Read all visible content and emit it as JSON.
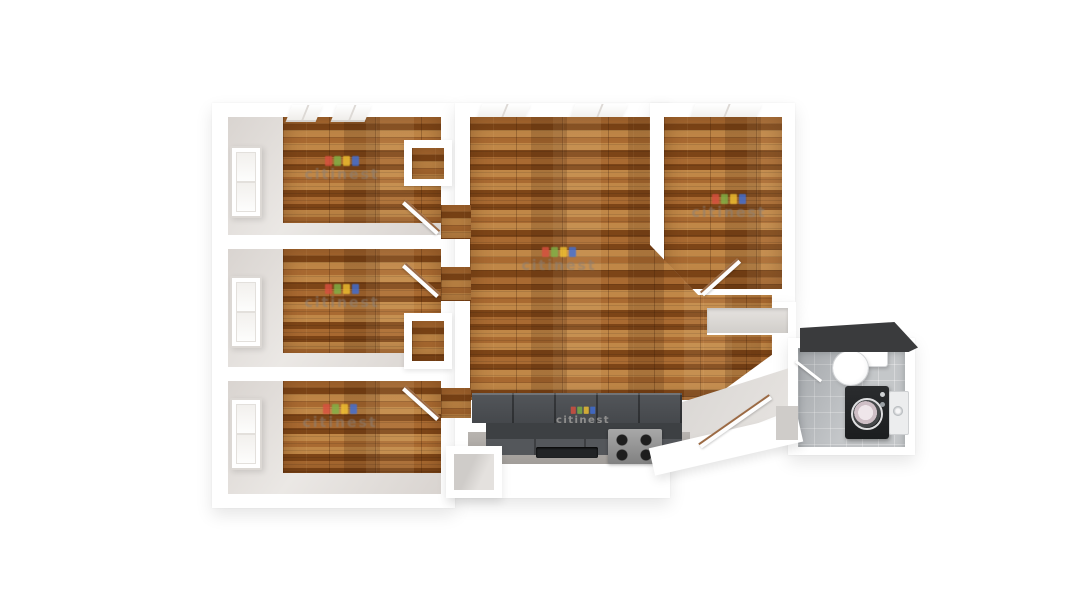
{
  "watermark": {
    "text": "citinest",
    "logo_colors": [
      "#d94f3f",
      "#7fb347",
      "#f2c230",
      "#3f6fd9"
    ]
  },
  "colors": {
    "wall_white": "#ffffff",
    "wall_face": "#d9d4d0",
    "wall_face_light": "#ebe8e5",
    "wood_light": "#c08747",
    "wood_mid": "#a96a31",
    "wood_dark": "#7d4517",
    "cabinet_upper": "#53565a",
    "cabinet_backsplash": "#3d4043",
    "cabinet_base": "#54575b",
    "counter_light": "#b8b4b0",
    "sink_dark": "#222426",
    "stove_steel": "#a8a8a8",
    "tile_base": "#bcbfc2",
    "appliance_black": "#1b1d1f",
    "roof_dark": "#3a3b3d",
    "entry_floor": "#d6d3d0",
    "watermark_text": "#8a8078"
  },
  "rooms": [
    {
      "id": "bedroom-top-left",
      "floor": "wood"
    },
    {
      "id": "bedroom-middle-left",
      "floor": "wood"
    },
    {
      "id": "bedroom-bottom-left",
      "floor": "wood"
    },
    {
      "id": "living-room",
      "floor": "wood"
    },
    {
      "id": "bedroom-top-right",
      "floor": "wood"
    },
    {
      "id": "kitchen",
      "floor": "wood"
    },
    {
      "id": "entry-hall",
      "floor": "concrete"
    },
    {
      "id": "bathroom",
      "floor": "tile"
    }
  ],
  "fixtures": [
    "windows",
    "doors",
    "kitchen-cabinets",
    "sink",
    "range",
    "toilet",
    "washing-machine",
    "water-heater",
    "closets"
  ]
}
